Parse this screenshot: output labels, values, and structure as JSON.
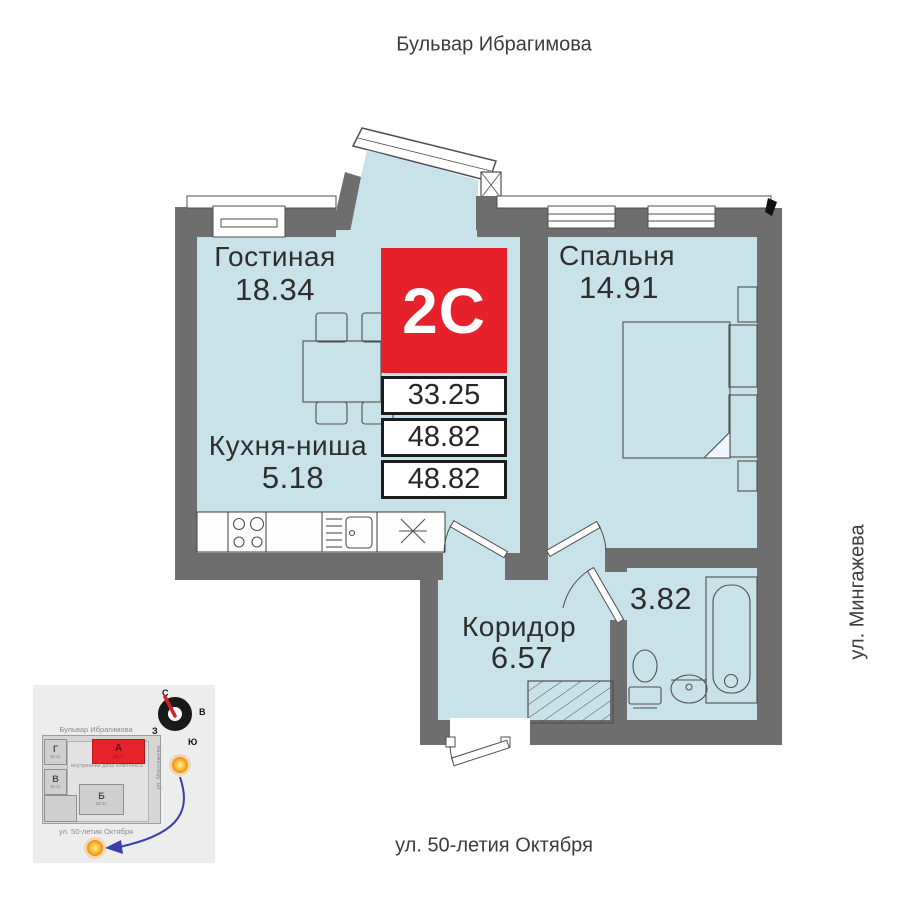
{
  "streets": {
    "top": "Бульвар Ибрагимова",
    "right": "ул. Мингажева",
    "bottom": "ул. 50-летия Октября"
  },
  "apartment": {
    "type": "2С",
    "areas": [
      "33.25",
      "48.82",
      "48.82"
    ]
  },
  "rooms": {
    "living": {
      "name": "Гостиная",
      "area": "18.34"
    },
    "bedroom": {
      "name": "Спальня",
      "area": "14.91"
    },
    "kitchen": {
      "name": "Кухня-ниша",
      "area": "5.18"
    },
    "corridor": {
      "name": "Коридор",
      "area": "6.57"
    },
    "bathroom": {
      "area": "3.82"
    }
  },
  "minimap": {
    "street_top": "Бульвар Ибрагимова",
    "street_right": "ул. Мингажева",
    "street_bottom": "ул. 50-летия Октября",
    "courtyard": "внутренний двор комплекса",
    "compass": {
      "n": "С",
      "e": "В",
      "w": "З",
      "s": "Ю"
    },
    "buildings": [
      {
        "label": "Г",
        "floors": "15 эт."
      },
      {
        "label": "В",
        "floors": "15 эт."
      },
      {
        "label": "А",
        "floors": "33 эт."
      },
      {
        "label": "Б",
        "floors": "20 эт."
      }
    ]
  },
  "colors": {
    "room_fill": "#c7e3e9",
    "wall": "#6e6e6e",
    "accent_red": "#e6212b"
  }
}
